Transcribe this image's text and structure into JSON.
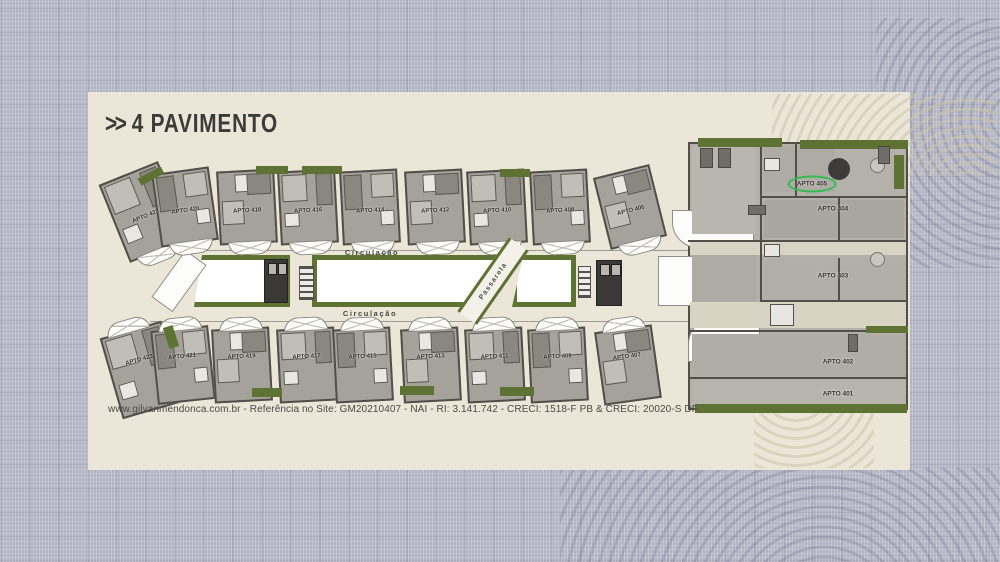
{
  "title": {
    "chevrons": ">>",
    "text": "4 PAVIMENTO"
  },
  "footer": {
    "text": "www.gilvanmendonca.com.br - Referência no Site: GM20210407  -  NAI - RI: 3.141.742 - CRECI: 1518-F PB & CRECI: 20020-S DF"
  },
  "plan": {
    "top_row": [
      "APTO 422",
      "APTO 420",
      "APTO 418",
      "APTO 416",
      "APTO 414",
      "APTO 412",
      "APTO 410",
      "APTO 408",
      "APTO 406"
    ],
    "bottom_row": [
      "APTO 423",
      "APTO 421",
      "APTO 419",
      "APTO 417",
      "APTO 415",
      "APTO 413",
      "APTO 411",
      "APTO 409",
      "APTO 407"
    ],
    "right_block": [
      "APTO 405",
      "APTO 404",
      "APTO 403",
      "APTO 402",
      "APTO 401"
    ],
    "highlighted_unit": "APTO 405",
    "corridor_labels": [
      "Circulação",
      "Circulação"
    ],
    "walkway_label": "Passarela"
  },
  "colors": {
    "card": "#ebe6d7",
    "fabric": "#b2b4c4",
    "grass": "#5e7333",
    "highlight_green": "#2fbe52",
    "wall": "#524f4a",
    "ink": "#3a3a38"
  }
}
